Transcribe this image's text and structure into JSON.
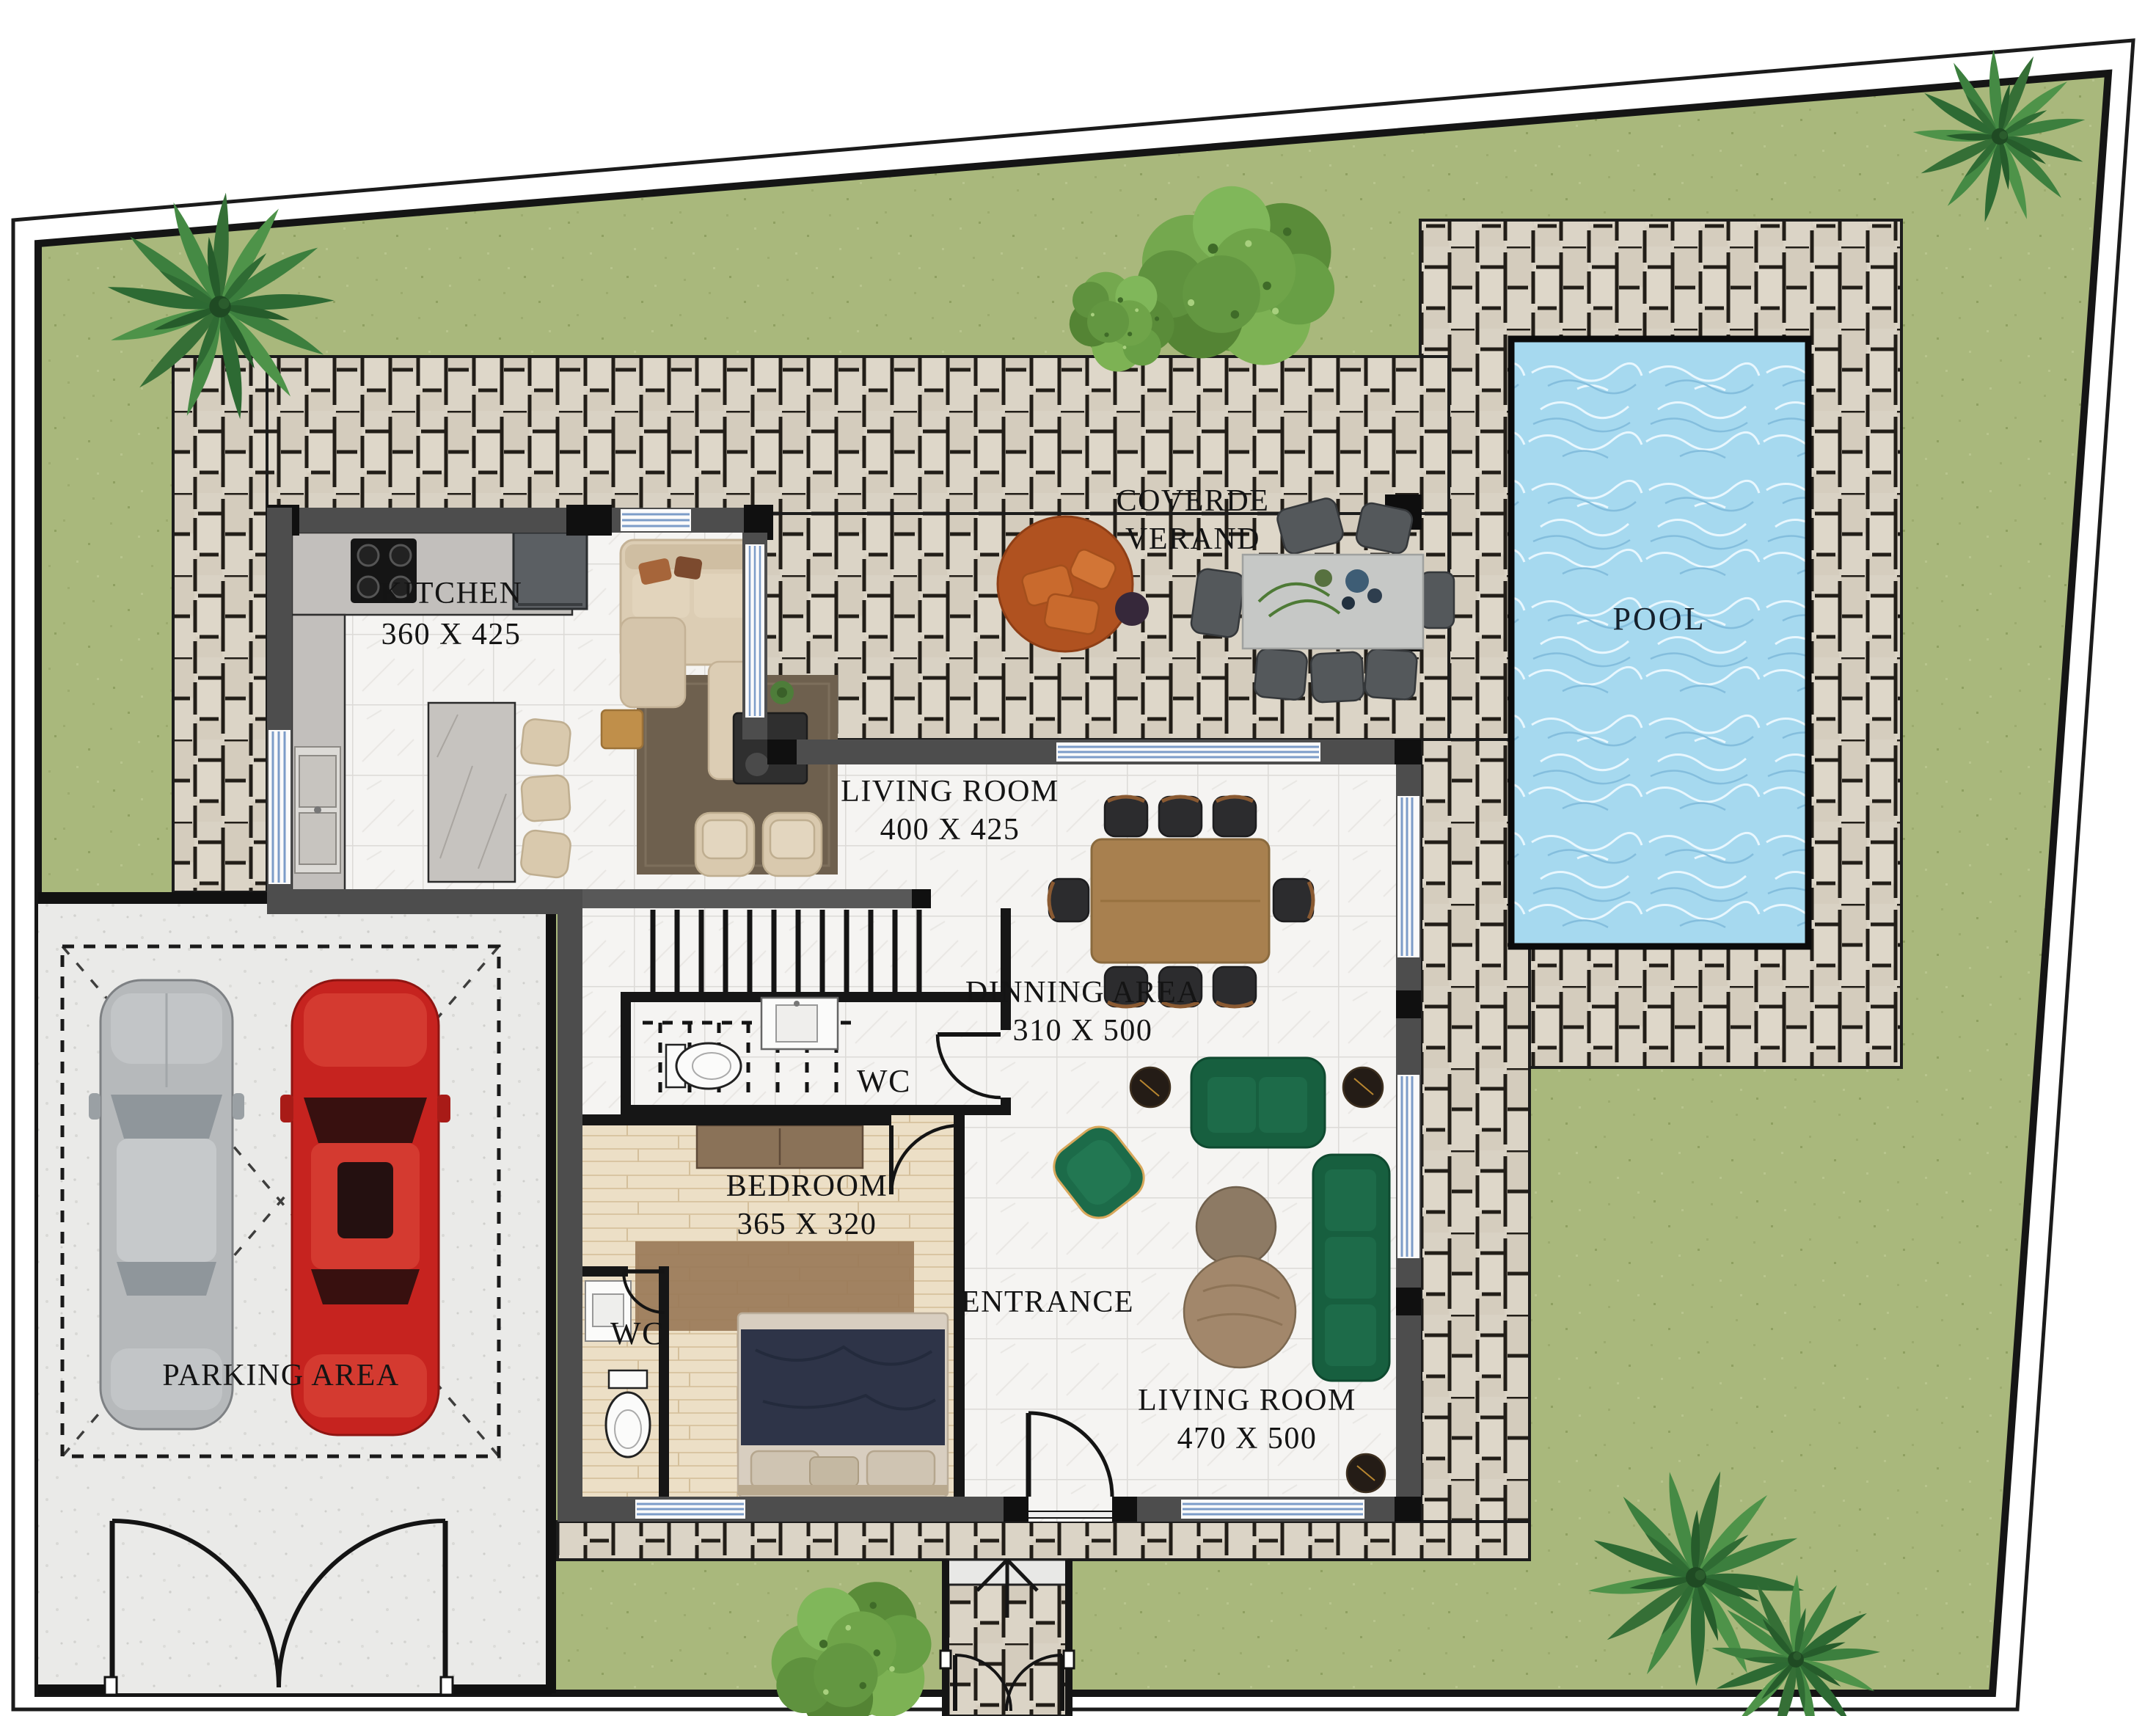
{
  "plan": {
    "type": "villa ground floor plan",
    "labels": {
      "kitchen": {
        "name": "KITCHEN",
        "dims": "360 X 425"
      },
      "living_room_open": {
        "name": "LIVING ROOM",
        "dims": "400 X 425"
      },
      "covered_veranda": {
        "line1": "COVERDE",
        "line2": "VERAND"
      },
      "pool": {
        "name": "POOL"
      },
      "dining_area": {
        "name": "DINNING AREA",
        "dims": "310 X 500"
      },
      "wc_understairs": {
        "name": "WC"
      },
      "bedroom": {
        "name": "BEDROOM",
        "dims": "365 X 320"
      },
      "wc_bedroom": {
        "name": "WC"
      },
      "entrance": {
        "name": "ENTRANCE"
      },
      "living_room_main": {
        "name": "LIVING ROOM",
        "dims": "470 X 500"
      },
      "parking": {
        "name": "PARKING AREA"
      }
    },
    "colors": {
      "grass": "#a9b87c",
      "paving": "#d9d2c4",
      "pool_water": "#a6d9ef",
      "interior_floor": "#f5f4f2",
      "bedroom_floor": "#ecdfc6",
      "concrete": "#eaeae8",
      "walls": "#4d4d4d",
      "wall_accent": "#141414",
      "sofa_green": "#1a6243",
      "sofa_beige": "#dccdb4",
      "daybed_orange": "#b05220",
      "car_red": "#c6231f",
      "car_gray": "#b6b9bb",
      "window_glass": "#7c9cc8"
    }
  }
}
